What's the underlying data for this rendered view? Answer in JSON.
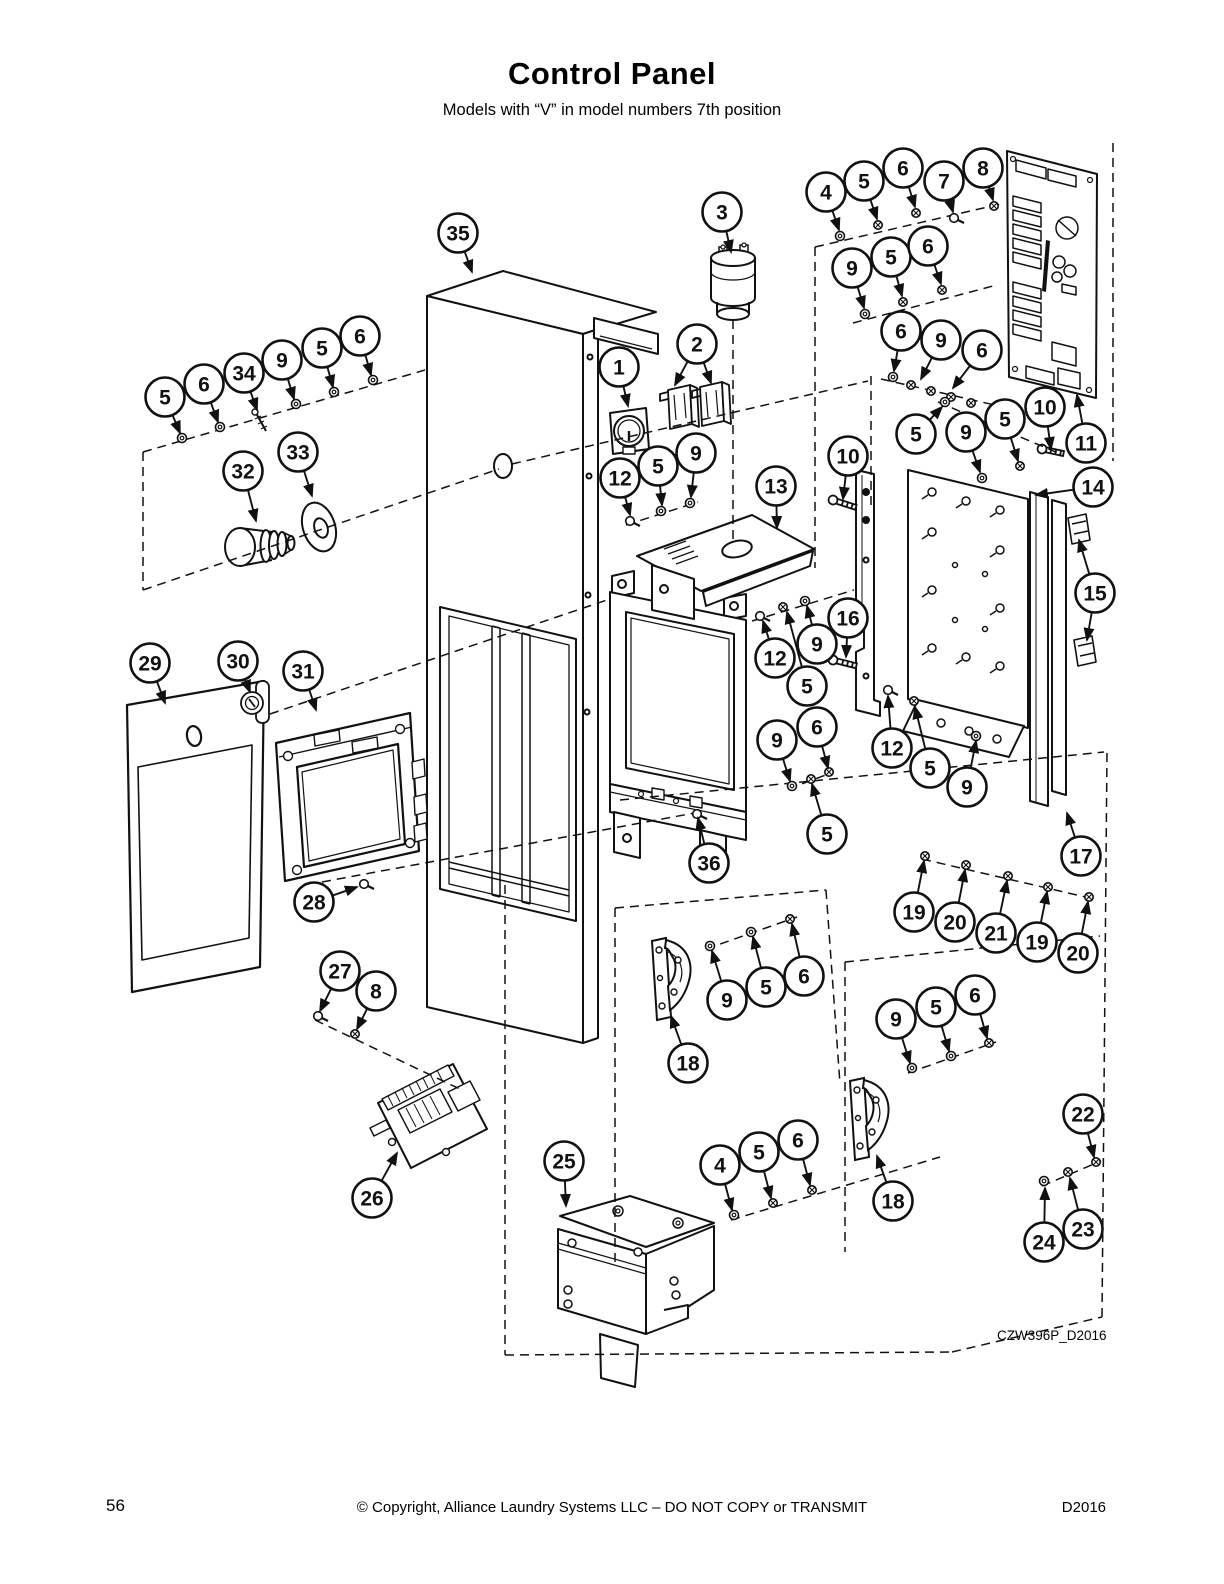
{
  "page": {
    "title": "Control Panel",
    "subtitle": "Models with “V” in model numbers 7th position",
    "diagram_code": "CZW396P_D2016",
    "footer": {
      "page_number": "56",
      "copyright": "© Copyright, Alliance Laundry Systems LLC – DO NOT COPY or TRANSMIT",
      "doc_code": "D2016"
    }
  },
  "diagram": {
    "type": "exploded-parts-view",
    "callouts": [
      {
        "n": "35",
        "x": 458,
        "y": 233,
        "tx": 472,
        "ty": 272
      },
      {
        "n": "3",
        "x": 722,
        "y": 212,
        "tx": 731,
        "ty": 252
      },
      {
        "n": "1",
        "x": 619,
        "y": 367,
        "tx": 628,
        "ty": 406
      },
      {
        "n": "2",
        "x": 697,
        "y": 344,
        "tx": 675,
        "ty": 385,
        "tx2": 711,
        "ty2": 383
      },
      {
        "n": "12",
        "x": 620,
        "y": 478,
        "tx": 630,
        "ty": 515
      },
      {
        "n": "5",
        "x": 658,
        "y": 466,
        "tx": 662,
        "ty": 505
      },
      {
        "n": "9",
        "x": 696,
        "y": 453,
        "tx": 691,
        "ty": 497
      },
      {
        "n": "13",
        "x": 776,
        "y": 486,
        "tx": 777,
        "ty": 528
      },
      {
        "n": "4",
        "x": 826,
        "y": 192,
        "tx": 839,
        "ty": 230
      },
      {
        "n": "5",
        "x": 864,
        "y": 181,
        "tx": 877,
        "ty": 219
      },
      {
        "n": "6",
        "x": 903,
        "y": 168,
        "tx": 915,
        "ty": 207
      },
      {
        "n": "7",
        "x": 944,
        "y": 181,
        "tx": 953,
        "ty": 212
      },
      {
        "n": "8",
        "x": 983,
        "y": 168,
        "tx": 993,
        "ty": 200
      },
      {
        "n": "9",
        "x": 852,
        "y": 268,
        "tx": 864,
        "ty": 308
      },
      {
        "n": "5",
        "x": 891,
        "y": 257,
        "tx": 902,
        "ty": 296
      },
      {
        "n": "6",
        "x": 928,
        "y": 246,
        "tx": 941,
        "ty": 284
      },
      {
        "n": "6",
        "x": 901,
        "y": 331,
        "tx": 894,
        "ty": 371
      },
      {
        "n": "9",
        "x": 941,
        "y": 340,
        "tx": 921,
        "ty": 379
      },
      {
        "n": "6",
        "x": 982,
        "y": 350,
        "tx": 953,
        "ty": 388
      },
      {
        "n": "5",
        "x": 916,
        "y": 434,
        "tx": 942,
        "ty": 407
      },
      {
        "n": "9",
        "x": 966,
        "y": 432,
        "tx": 980,
        "ty": 472
      },
      {
        "n": "5",
        "x": 1005,
        "y": 419,
        "tx": 1018,
        "ty": 461
      },
      {
        "n": "10",
        "x": 1045,
        "y": 407,
        "tx": 1051,
        "ty": 449
      },
      {
        "n": "11",
        "x": 1086,
        "y": 443,
        "tx": 1077,
        "ty": 395
      },
      {
        "n": "10",
        "x": 848,
        "y": 456,
        "tx": 843,
        "ty": 499
      },
      {
        "n": "14",
        "x": 1093,
        "y": 487,
        "tx": 1036,
        "ty": 495
      },
      {
        "n": "15",
        "x": 1095,
        "y": 593,
        "tx": 1079,
        "ty": 540,
        "tx2": 1087,
        "ty2": 640
      },
      {
        "n": "16",
        "x": 848,
        "y": 618,
        "tx": 846,
        "ty": 657
      },
      {
        "n": "12",
        "x": 775,
        "y": 658,
        "tx": 763,
        "ty": 621
      },
      {
        "n": "9",
        "x": 817,
        "y": 644,
        "tx": 807,
        "ty": 606
      },
      {
        "n": "5",
        "x": 807,
        "y": 686,
        "tx": 787,
        "ty": 612
      },
      {
        "n": "9",
        "x": 777,
        "y": 740,
        "tx": 790,
        "ty": 781
      },
      {
        "n": "6",
        "x": 817,
        "y": 727,
        "tx": 828,
        "ty": 768
      },
      {
        "n": "5",
        "x": 827,
        "y": 834,
        "tx": 812,
        "ty": 784
      },
      {
        "n": "36",
        "x": 709,
        "y": 863,
        "tx": 698,
        "ty": 818
      },
      {
        "n": "12",
        "x": 892,
        "y": 748,
        "tx": 888,
        "ty": 696
      },
      {
        "n": "5",
        "x": 930,
        "y": 768,
        "tx": 915,
        "ty": 707
      },
      {
        "n": "9",
        "x": 967,
        "y": 787,
        "tx": 976,
        "ty": 741
      },
      {
        "n": "17",
        "x": 1081,
        "y": 856,
        "tx": 1067,
        "ty": 813
      },
      {
        "n": "19",
        "x": 914,
        "y": 912,
        "tx": 924,
        "ty": 861
      },
      {
        "n": "20",
        "x": 955,
        "y": 922,
        "tx": 965,
        "ty": 870
      },
      {
        "n": "21",
        "x": 996,
        "y": 933,
        "tx": 1007,
        "ty": 881
      },
      {
        "n": "19",
        "x": 1037,
        "y": 942,
        "tx": 1047,
        "ty": 892
      },
      {
        "n": "20",
        "x": 1078,
        "y": 953,
        "tx": 1088,
        "ty": 902
      },
      {
        "n": "5",
        "x": 165,
        "y": 397,
        "tx": 180,
        "ty": 433
      },
      {
        "n": "6",
        "x": 204,
        "y": 384,
        "tx": 218,
        "ty": 422
      },
      {
        "n": "34",
        "x": 244,
        "y": 373,
        "tx": 257,
        "ty": 410
      },
      {
        "n": "9",
        "x": 282,
        "y": 360,
        "tx": 294,
        "ty": 399
      },
      {
        "n": "5",
        "x": 322,
        "y": 348,
        "tx": 333,
        "ty": 387
      },
      {
        "n": "6",
        "x": 360,
        "y": 336,
        "tx": 371,
        "ty": 375
      },
      {
        "n": "32",
        "x": 243,
        "y": 471,
        "tx": 256,
        "ty": 521
      },
      {
        "n": "33",
        "x": 298,
        "y": 452,
        "tx": 312,
        "ty": 496
      },
      {
        "n": "29",
        "x": 150,
        "y": 663,
        "tx": 165,
        "ty": 703
      },
      {
        "n": "30",
        "x": 238,
        "y": 661,
        "tx": 250,
        "ty": 692
      },
      {
        "n": "31",
        "x": 303,
        "y": 671,
        "tx": 316,
        "ty": 710
      },
      {
        "n": "28",
        "x": 314,
        "y": 902,
        "tx": 357,
        "ty": 887
      },
      {
        "n": "27",
        "x": 340,
        "y": 971,
        "tx": 320,
        "ty": 1011
      },
      {
        "n": "8",
        "x": 376,
        "y": 991,
        "tx": 357,
        "ty": 1029
      },
      {
        "n": "26",
        "x": 372,
        "y": 1198,
        "tx": 397,
        "ty": 1153
      },
      {
        "n": "18",
        "x": 688,
        "y": 1063,
        "tx": 671,
        "ty": 1016
      },
      {
        "n": "9",
        "x": 727,
        "y": 1000,
        "tx": 712,
        "ty": 951
      },
      {
        "n": "5",
        "x": 766,
        "y": 987,
        "tx": 753,
        "ty": 937
      },
      {
        "n": "6",
        "x": 804,
        "y": 976,
        "tx": 792,
        "ty": 924
      },
      {
        "n": "9",
        "x": 896,
        "y": 1019,
        "tx": 910,
        "ty": 1063
      },
      {
        "n": "5",
        "x": 936,
        "y": 1007,
        "tx": 949,
        "ty": 1051
      },
      {
        "n": "6",
        "x": 975,
        "y": 995,
        "tx": 987,
        "ty": 1038
      },
      {
        "n": "18",
        "x": 893,
        "y": 1201,
        "tx": 877,
        "ty": 1156
      },
      {
        "n": "25",
        "x": 564,
        "y": 1161,
        "tx": 566,
        "ty": 1206
      },
      {
        "n": "4",
        "x": 720,
        "y": 1165,
        "tx": 732,
        "ty": 1210
      },
      {
        "n": "5",
        "x": 759,
        "y": 1152,
        "tx": 771,
        "ty": 1198
      },
      {
        "n": "6",
        "x": 798,
        "y": 1140,
        "tx": 810,
        "ty": 1185
      },
      {
        "n": "22",
        "x": 1083,
        "y": 1114,
        "tx": 1094,
        "ty": 1157
      },
      {
        "n": "23",
        "x": 1083,
        "y": 1229,
        "tx": 1070,
        "ty": 1178
      },
      {
        "n": "24",
        "x": 1044,
        "y": 1242,
        "tx": 1045,
        "ty": 1188
      }
    ]
  }
}
